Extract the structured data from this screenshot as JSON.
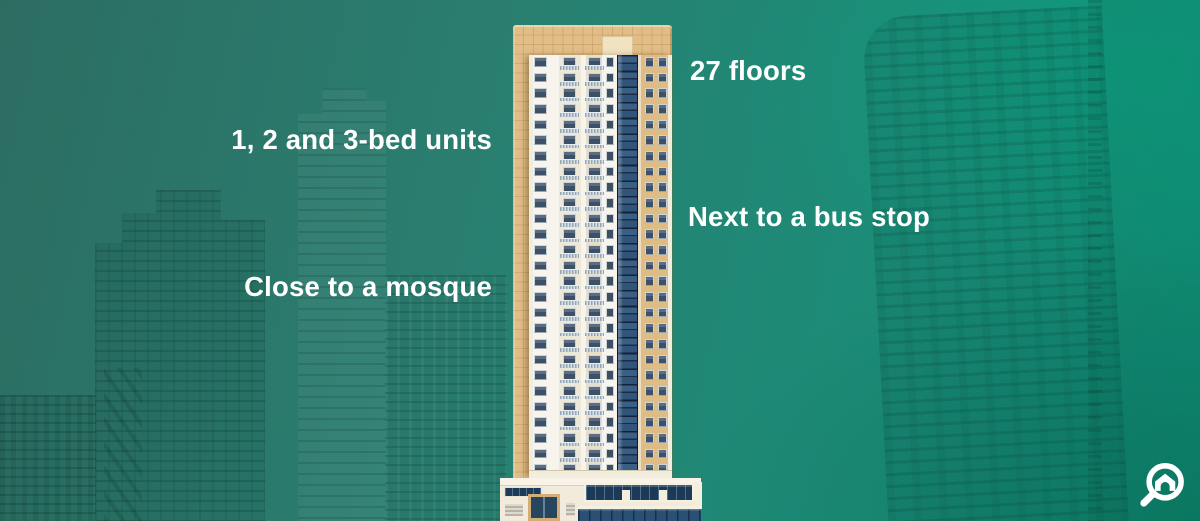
{
  "annotations": {
    "floors": "27 floors",
    "units": "1, 2 and 3-bed units",
    "bus": "Next to a bus stop",
    "mosque": "Close to a mosque"
  },
  "building": {
    "floors": 27
  },
  "icons": {
    "logo": "house-search-icon"
  },
  "colors": {
    "background_teal_left": "#2c6d62",
    "background_teal_right": "#0f9279",
    "building_tan": "#e1bd87",
    "facade_cream": "#f7f4ed",
    "glass_navy": "#1c3a57",
    "label_text": "#ffffff",
    "logo": "#ffffff"
  }
}
